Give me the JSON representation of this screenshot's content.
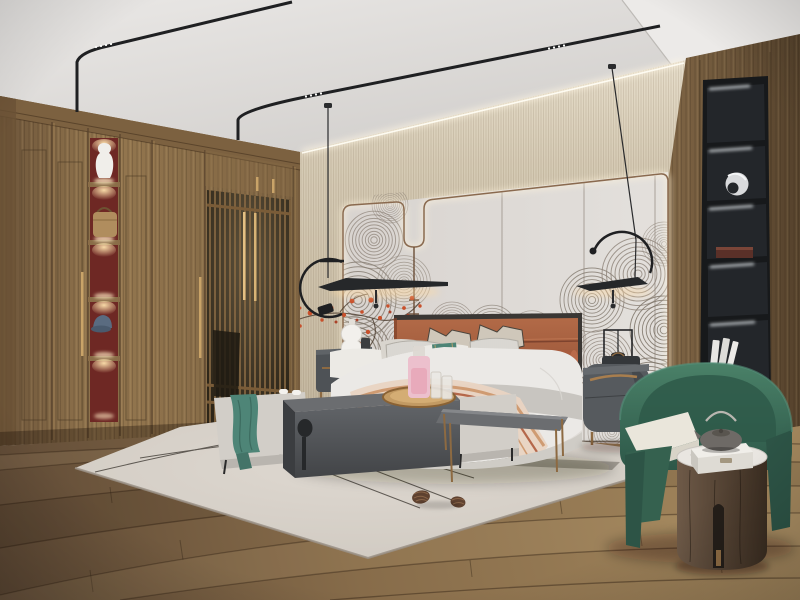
{
  "meta": {
    "app": "interior-render",
    "description": "Photorealistic 3D render of a modern Chinese-style bedroom: walnut wardrobe with lattice doors and lit display niches, upholstered bed with terracotta headboard against a wave-mural accent wall, two black pendant lamps, charcoal nightstands, bench with waterfall side table, layered rug with pinecones, green barrel armchair with drum side table and teapot, and a black display shelf column.",
    "width": 800,
    "height": 600
  },
  "palette": {
    "ceiling": "#dbd8d5",
    "beam": "#eceae8",
    "wall_beige": "#cfc4ad",
    "wall_beige_dark": "#bdb098",
    "panel": "#dedad6",
    "panel_trim": "#8a6a4f",
    "led_glow": "#fff4dc",
    "wood": "#8c6f4a",
    "wood_dark": "#6b5336",
    "wood_right": "#72593c",
    "niche_red": "#6e2824",
    "brass": "#c9a368",
    "bronze": "#8d6a42",
    "shelf_black": "#17191b",
    "niche_black": "#23262a",
    "floor": "#947955",
    "floor_dark": "#5b4733",
    "rug": "#d6d0c9",
    "rug_edge": "#9a9186",
    "rug_line": "#413c36",
    "bed_white": "#ebe9e6",
    "bed_base": "#cfccc6",
    "blanket_gray": "#c6c3be",
    "headboard": "#a3593c",
    "head_frame": "#3a3734",
    "pillow_tan": "#cfc7ba",
    "pillow_gray": "#d9d5ce",
    "teal": "#4d8476",
    "throw_cream": "#e8d4c2",
    "throw_rust": "#b5674a",
    "throw_tan": "#cf9b72",
    "charcoal": "#54575a",
    "charcoal_dark": "#46484b",
    "charcoal_top": "#6b6d70",
    "nightstand": "#565a5e",
    "chair_green": "#3c6e5d",
    "cushion": "#eae6db",
    "cyl_wood": "#5c4a3b",
    "marble": "#e9e6e1",
    "track_black": "#1f2022",
    "red_accent": "#c8502b",
    "lamp_warm": "#ffd9a0",
    "white": "#f2f0ec",
    "art_stroke": "#8e8379",
    "pink": "#ecc0cd",
    "teal_throw": "#4e8577",
    "denim": "#5a6b80",
    "tan_bag": "#b08d5e",
    "teapot": "#6e6a66"
  },
  "scene": {
    "room": "bedroom",
    "style": "modern new-Chinese style",
    "objects": [
      {
        "id": "ceiling",
        "label": "white plaster ceiling with black magnetic track lights"
      },
      {
        "id": "cove-light",
        "label": "LED cove lighting above accent wall"
      },
      {
        "id": "wardrobe",
        "label": "walnut wardrobe wall with long brass pulls"
      },
      {
        "id": "display-column",
        "label": "red-backed open display niches with spotlights"
      },
      {
        "id": "display-vase",
        "label": "white ceramic vase"
      },
      {
        "id": "handbag",
        "label": "tan leather handbag"
      },
      {
        "id": "baseball-cap",
        "label": "blue cap"
      },
      {
        "id": "lattice-doors",
        "label": "slatted lattice wardrobe doors"
      },
      {
        "id": "accent-wall",
        "label": "beige panelled accent wall with bronze LED contour"
      },
      {
        "id": "wave-mural",
        "label": "grey concentric wave / fan mural"
      },
      {
        "id": "blossom-branch",
        "label": "red blossom branch"
      },
      {
        "id": "pendant-lamp-left",
        "label": "black disc pendant lamp with arc"
      },
      {
        "id": "pendant-lamp-right",
        "label": "black disc pendant lamp with arc"
      },
      {
        "id": "bed",
        "label": "upholstered platform bed with white bedding"
      },
      {
        "id": "headboard",
        "label": "terracotta leather channel headboard"
      },
      {
        "id": "pillows",
        "label": "layered pillows with teal accent band"
      },
      {
        "id": "throw-blanket",
        "label": "striped terracotta throw"
      },
      {
        "id": "nightstand-left",
        "label": "charcoal nightstand with white gourd lamp"
      },
      {
        "id": "nightstand-right",
        "label": "rounded charcoal nightstand with wireframe lamp"
      },
      {
        "id": "bench",
        "label": "upholstered bench with teal runner"
      },
      {
        "id": "waterfall-table",
        "label": "charcoal waterfall side table"
      },
      {
        "id": "tray",
        "label": "round wood tray with pink decanter and glasses"
      },
      {
        "id": "nesting-table",
        "label": "grey nesting table with bronze legs"
      },
      {
        "id": "rug",
        "label": "ivory area rug with fine line pattern"
      },
      {
        "id": "pinecones",
        "label": "two pinecones on rug"
      },
      {
        "id": "armchair",
        "label": "green barrel armchair with cream cushion"
      },
      {
        "id": "drum-table",
        "label": "dark wood drum side table with marble top"
      },
      {
        "id": "teapot",
        "label": "grey cast teapot on marble box"
      },
      {
        "id": "shelf-column",
        "label": "black built-in display shelf with LED strips"
      },
      {
        "id": "sculpture",
        "label": "silver abstract sculpture"
      },
      {
        "id": "books",
        "label": "white books"
      },
      {
        "id": "wood-floor",
        "label": "rustic oak plank floor"
      }
    ]
  }
}
